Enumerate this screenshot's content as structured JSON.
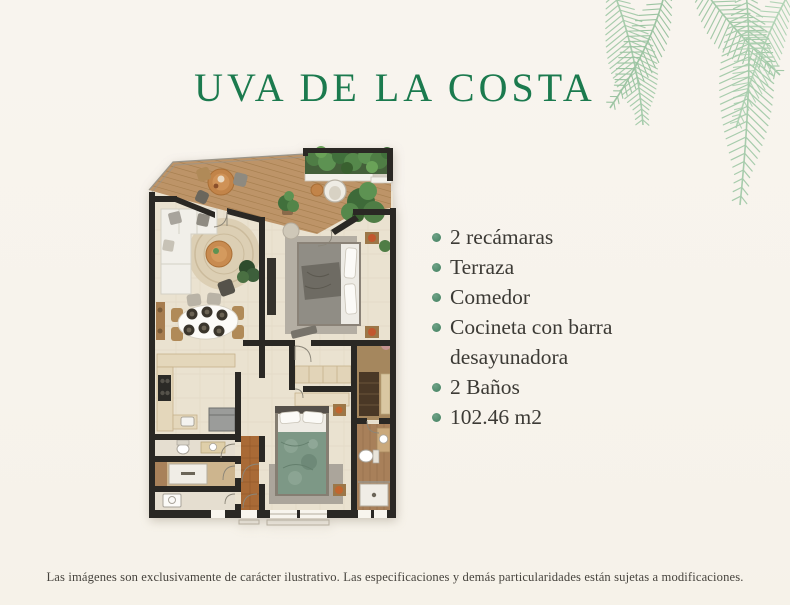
{
  "title": {
    "text": "UVA DE LA COSTA",
    "color": "#1b7a4e"
  },
  "features": {
    "bullet_icon": "leaf-dot",
    "bullet_color": "#4f8a6b",
    "items": [
      "2 recámaras",
      "Terraza",
      "Comedor",
      "Cocineta con barra desayunadora",
      "2 Baños",
      "102.46 m2"
    ]
  },
  "disclaimer": "Las imágenes son exclusivamente de carácter ilustrativo. Las especificaciones y demás particularidades están sujetas a modificaciones.",
  "colors": {
    "background": "#f7f3ec",
    "palm_leaves": "#a7ccac",
    "plan_walls": "#2a2824",
    "plan_wood_deck": "#bd9468",
    "plan_floor": "#eae2d0"
  }
}
